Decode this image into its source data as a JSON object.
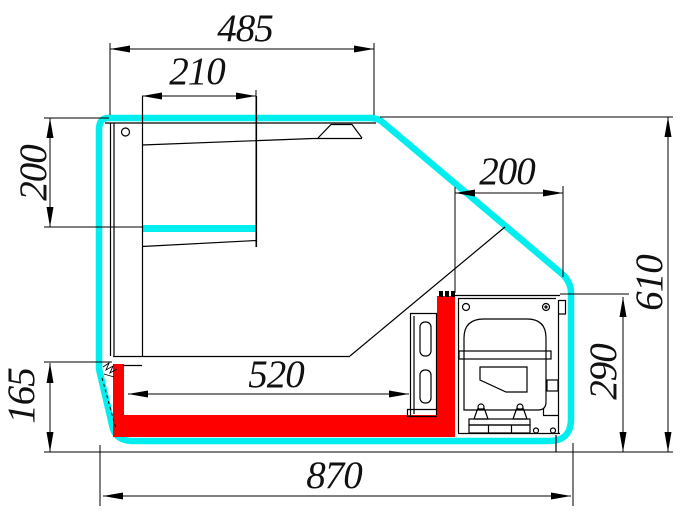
{
  "drawing": {
    "title": "refrigerated-counter-cross-section",
    "colors": {
      "outline": "#00eeee",
      "basin": "#ff0000",
      "line": "#000000",
      "background": "#ffffff"
    },
    "dims": {
      "top_width": "485",
      "canopy_width": "210",
      "display_opening_height": "200",
      "machine_top_width": "200",
      "overall_height": "610",
      "machine_compartment_height": "290",
      "well_width": "520",
      "base_height": "165",
      "overall_depth": "870"
    }
  }
}
